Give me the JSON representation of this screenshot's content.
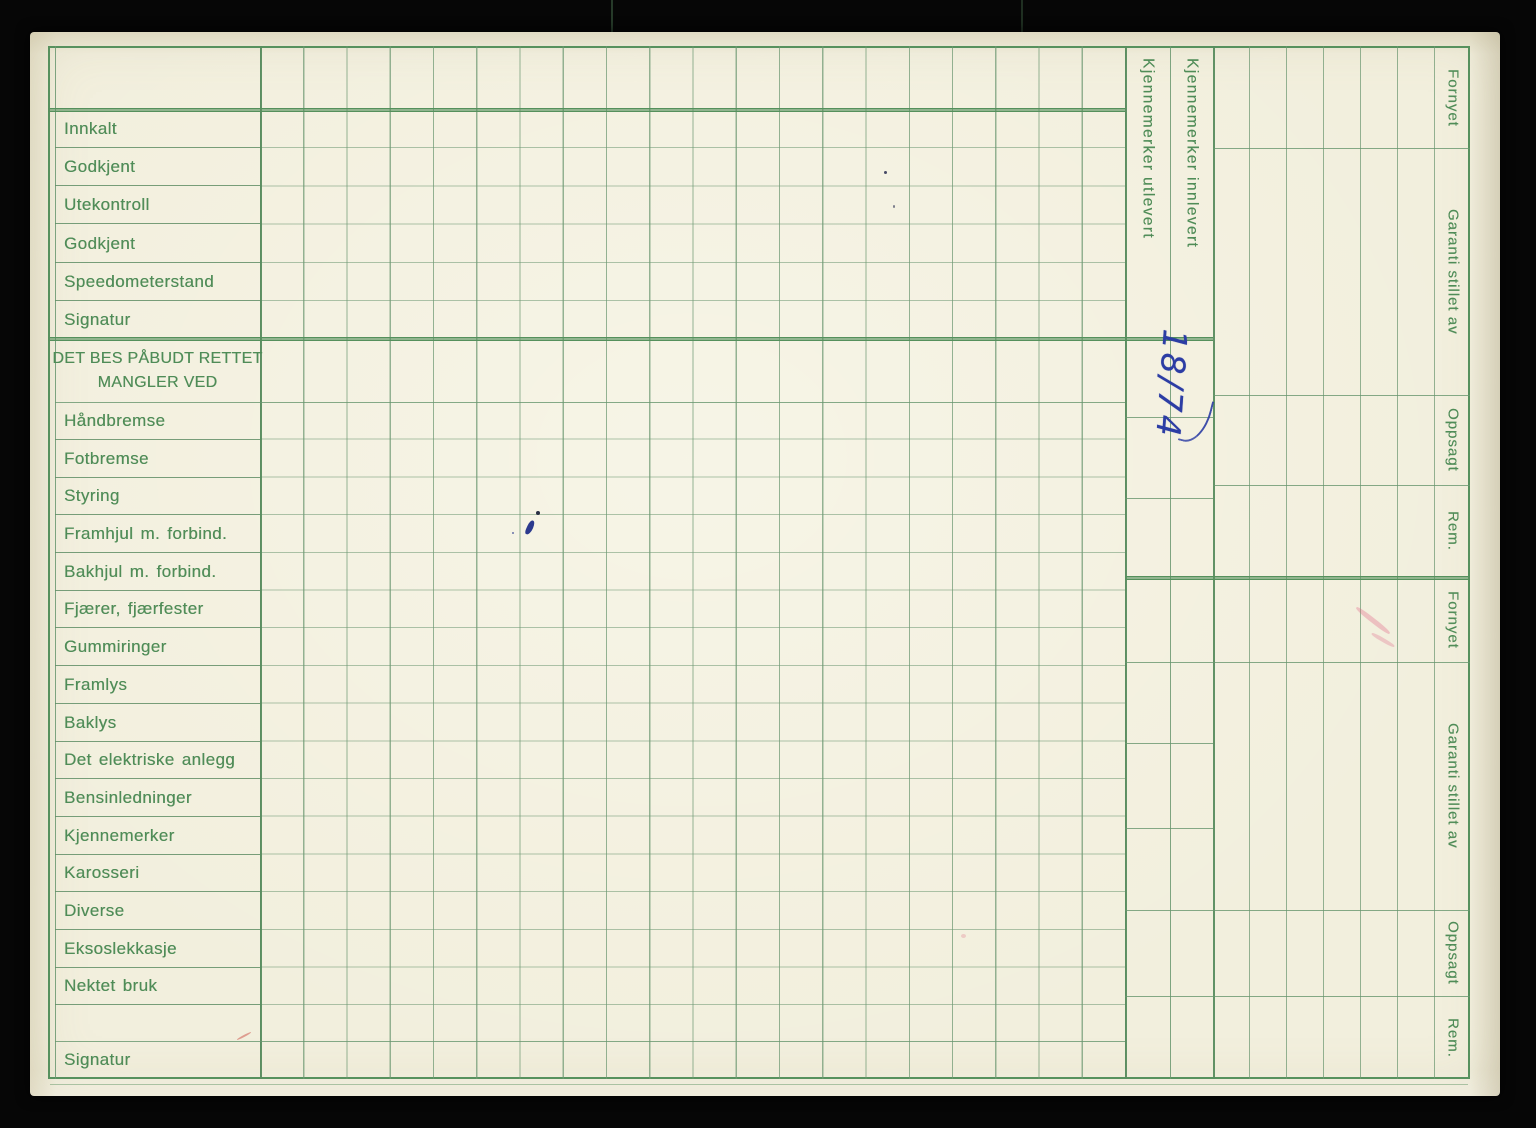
{
  "inspection_rows": [
    "Innkalt",
    "Godkjent",
    "Utekontroll",
    "Godkjent",
    "Speedometerstand",
    "Signatur"
  ],
  "defect_section": {
    "header_line1": "DET BES PÅBUDT RETTET",
    "header_line2": "MANGLER VED",
    "rows": [
      "Håndbremse",
      "Fotbremse",
      "Styring",
      "Framhjul m. forbind.",
      "Bakhjul m. forbind.",
      "Fjærer, fjærfester",
      "Gummiringer",
      "Framlys",
      "Baklys",
      "Det elektriske anlegg",
      "Bensinledninger",
      "Kjennemerker",
      "Karosseri",
      "Diverse",
      "Eksoslekkasje",
      "Nektet bruk"
    ],
    "signature_row": "Signatur"
  },
  "plate_columns": [
    {
      "label": "Kjennemerker utlevert"
    },
    {
      "label": "Kjennemerker innlevert"
    }
  ],
  "status_sections": [
    {
      "labels": [
        "Fornyet",
        "Garanti stillet av",
        "Oppsagt",
        "Rem."
      ]
    },
    {
      "labels": [
        "Fornyet",
        "Garanti stillet av",
        "Oppsagt",
        "Rem."
      ]
    }
  ],
  "annotations": {
    "handwritten_date": "18/74",
    "ink_color": "#2c3da4"
  },
  "colors": {
    "paper": "#f2efdd",
    "grid_line": "#7ba17d",
    "heavy_line": "#55905c",
    "text_green": "#4f8c57",
    "background": "#060606"
  }
}
